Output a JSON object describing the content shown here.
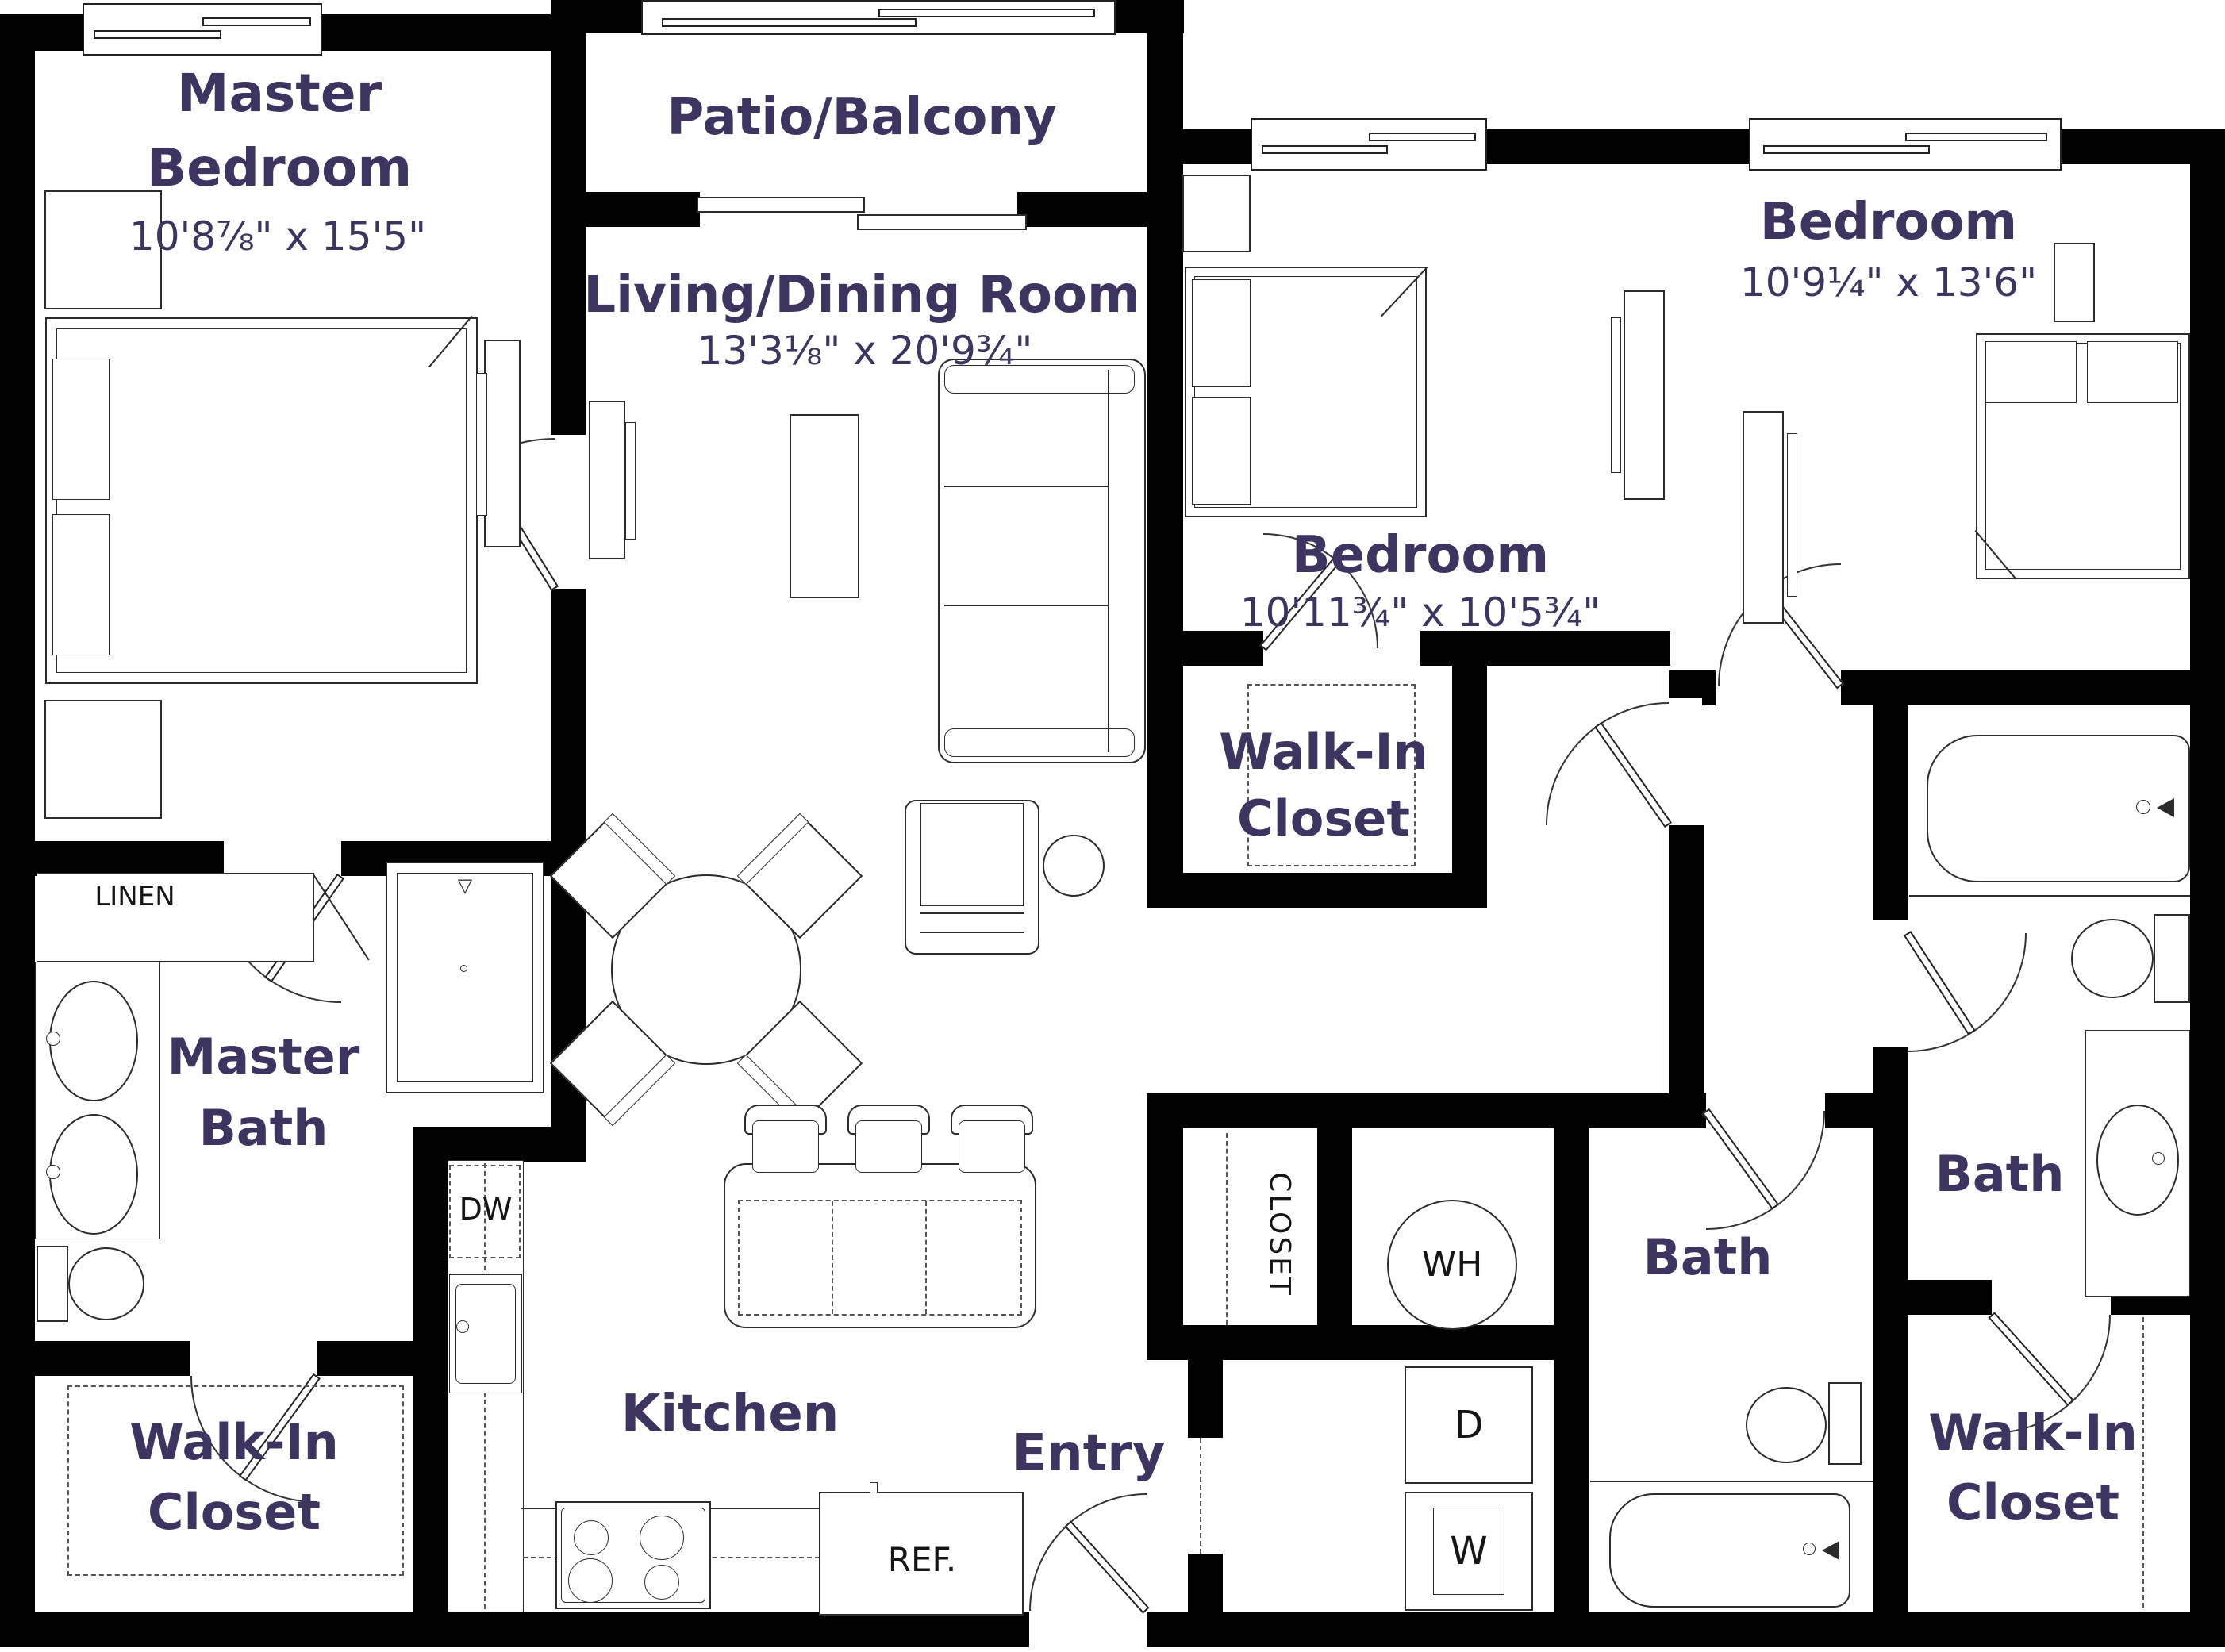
{
  "rooms": {
    "master_bedroom": {
      "line1": "Master",
      "line2": "Bedroom",
      "dims": "10'8⅞\" x 15'5\""
    },
    "patio_balcony": {
      "name": "Patio/Balcony"
    },
    "living_dining": {
      "name": "Living/Dining Room",
      "dims": "13'3⅛\" x 20'9¾\""
    },
    "bedroom_middle": {
      "name": "Bedroom",
      "dims": "10'11¾\" x 10'5¾\""
    },
    "bedroom_right": {
      "name": "Bedroom",
      "dims": "10'9¼\" x 13'6\""
    },
    "walkin_middle": {
      "line1": "Walk-In",
      "line2": "Closet"
    },
    "master_bath": {
      "line1": "Master",
      "line2": "Bath"
    },
    "walkin_master": {
      "line1": "Walk-In",
      "line2": "Closet"
    },
    "kitchen": {
      "name": "Kitchen"
    },
    "entry": {
      "name": "Entry"
    },
    "bath_middle": {
      "name": "Bath"
    },
    "bath_right": {
      "name": "Bath"
    },
    "walkin_right": {
      "line1": "Walk-In",
      "line2": "Closet"
    }
  },
  "appliances": {
    "linen": "LINEN",
    "dishwasher": "DW",
    "closet": "CLOSET",
    "water_heater": "WH",
    "dryer": "D",
    "washer": "W",
    "refrigerator": "REF."
  },
  "colors": {
    "label": "#3d3560",
    "wall": "#000000",
    "line": "#2b2b2b"
  }
}
